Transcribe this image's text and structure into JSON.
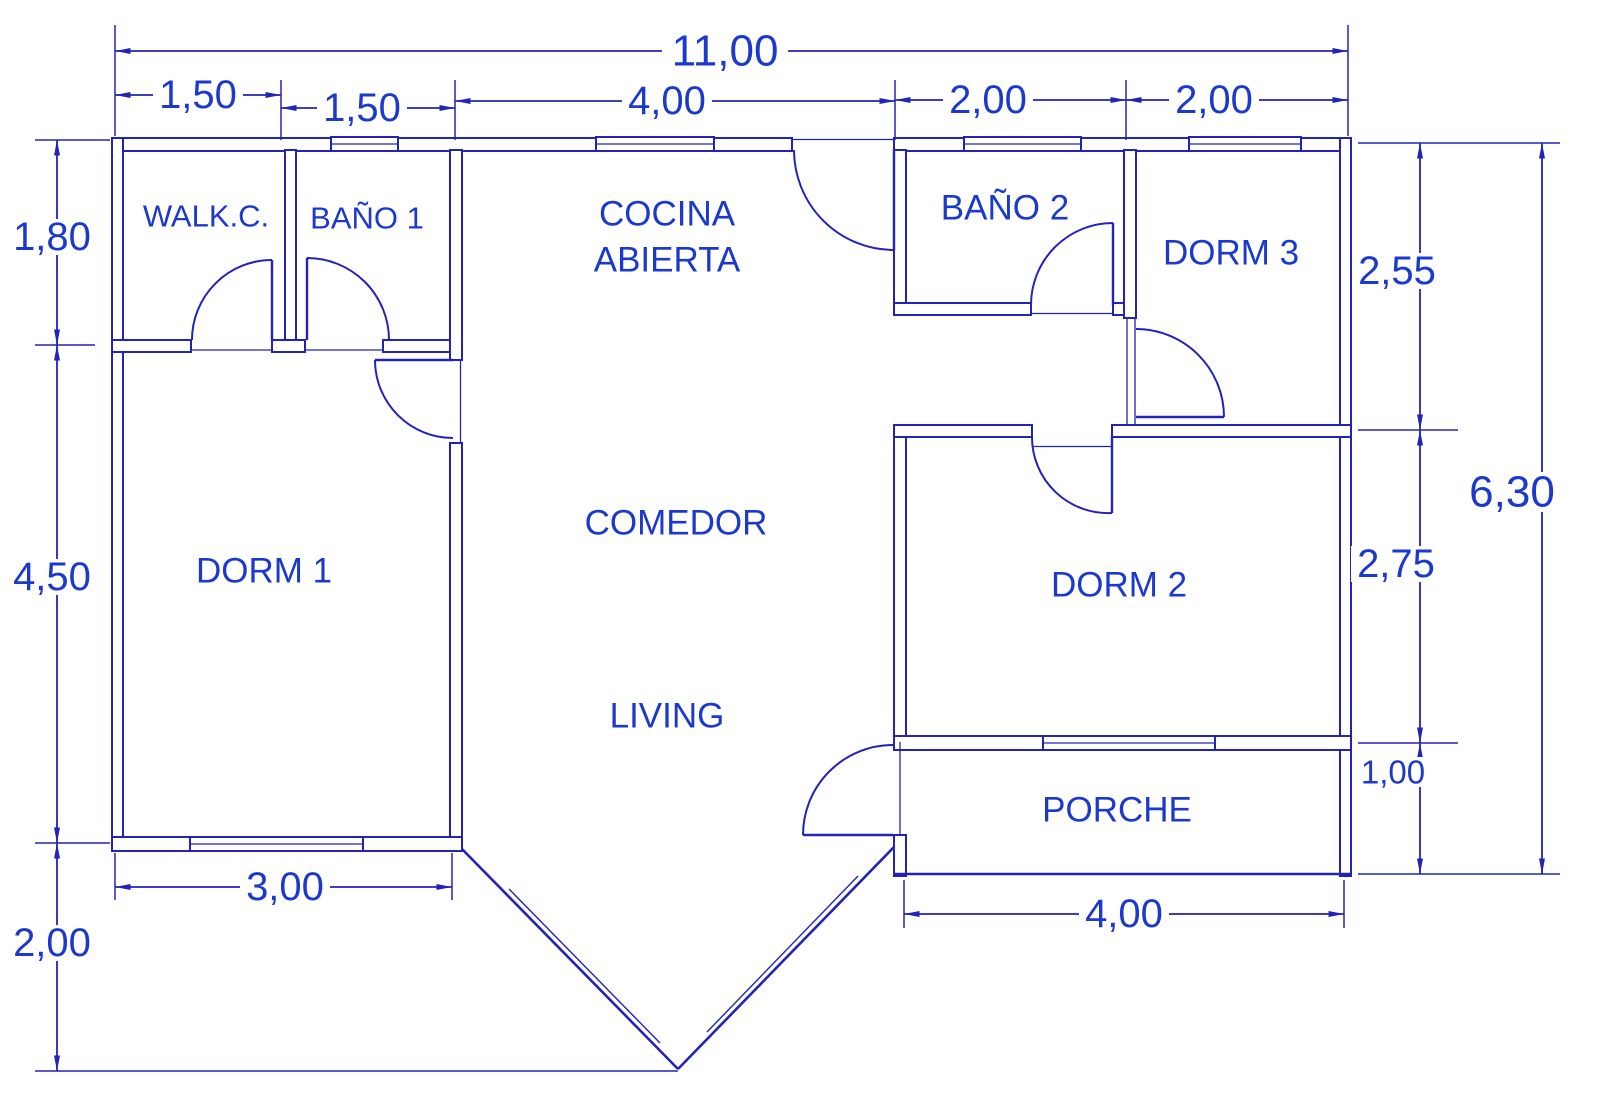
{
  "rooms": {
    "walk_closet": "WALK.C.",
    "bath1": "BAÑO 1",
    "kitchen1": "COCINA",
    "kitchen2": "ABIERTA",
    "bath2": "BAÑO 2",
    "dorm3": "DORM 3",
    "dorm1": "DORM 1",
    "dining": "COMEDOR",
    "dorm2": "DORM 2",
    "living": "LIVING",
    "porch": "PORCHE"
  },
  "dimensions": {
    "total_width": "11,00",
    "top": [
      "1,50",
      "1,50",
      "4,00",
      "2,00",
      "2,00"
    ],
    "left": [
      "1,80",
      "4,50",
      "2,00"
    ],
    "right": [
      "2,55",
      "2,75",
      "1,00"
    ],
    "total_height": "6,30",
    "bottom_left": "3,00",
    "bottom_right": "4,00"
  },
  "colors": {
    "line": "#2323b8",
    "text": "#1c39cd",
    "background": "#ffffff"
  }
}
